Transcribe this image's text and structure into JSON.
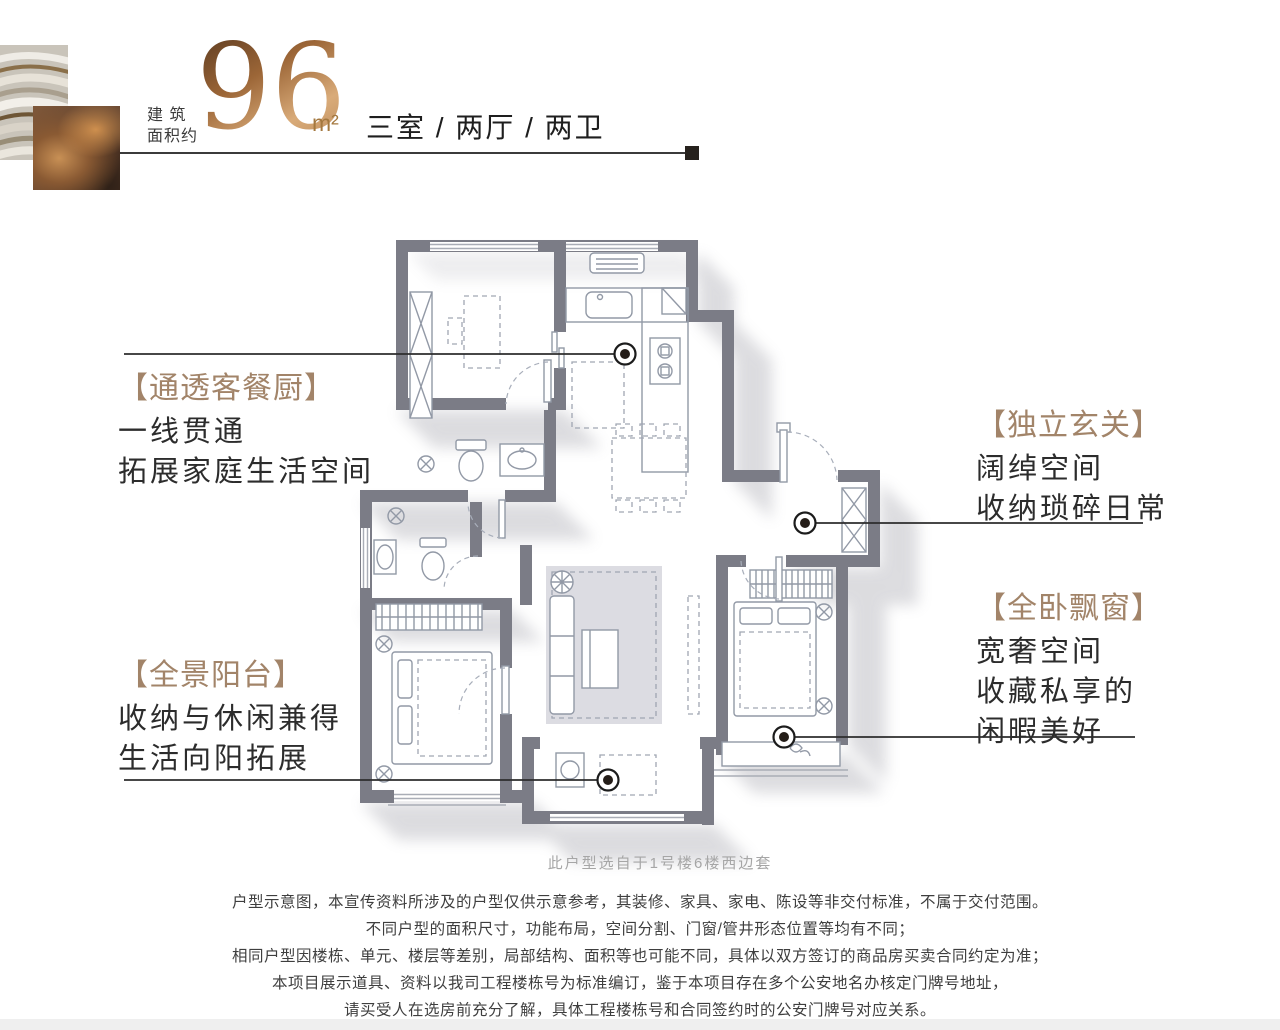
{
  "header": {
    "area_label_line1": "建 筑",
    "area_label_line2": "面积约",
    "area_value": "96",
    "area_unit": "m²",
    "layout_text": "三室 / 两厅 / 两卫"
  },
  "callouts": [
    {
      "id": "kitchen",
      "title": "【通透客餐厨】",
      "lines": [
        "一线贯通",
        "拓展家庭生活空间"
      ]
    },
    {
      "id": "foyer",
      "title": "【独立玄关】",
      "lines": [
        "阔绰空间",
        "收纳琐碎日常"
      ]
    },
    {
      "id": "baywindow",
      "title": "【全卧飘窗】",
      "lines": [
        "宽奢空间",
        "收藏私享的",
        "闲暇美好"
      ]
    },
    {
      "id": "balcony",
      "title": "【全景阳台】",
      "lines": [
        "收纳与休闲兼得",
        "生活向阳拓展"
      ]
    }
  ],
  "floorplan": {
    "caption": "此户型选自于1号楼6楼西边套"
  },
  "disclaimer": {
    "lines": [
      "户型示意图，本宣传资料所涉及的户型仅供示意参考，其装修、家具、家电、陈设等非交付标准，不属于交付范围。",
      "不同户型的面积尺寸，功能布局，空间分割、门窗/管井形态位置等均有不同；",
      "相同户型因楼栋、单元、楼层等差别，局部结构、面积等也可能不同，具体以双方签订的商品房买卖合同约定为准；",
      "本项目展示道具、资料以我司工程楼栋号为标准编订，鉴于本项目存在多个公安地名办核定门牌号地址，",
      "请买受人在选房前充分了解，具体工程楼栋号和合同签约时的公安门牌号对应关系。"
    ]
  },
  "colors": {
    "accent_bronze": "#a28469",
    "wall_gray": "#7b7c86",
    "body_text": "#2c2c2c",
    "caption_gray": "#a6a6a6"
  }
}
